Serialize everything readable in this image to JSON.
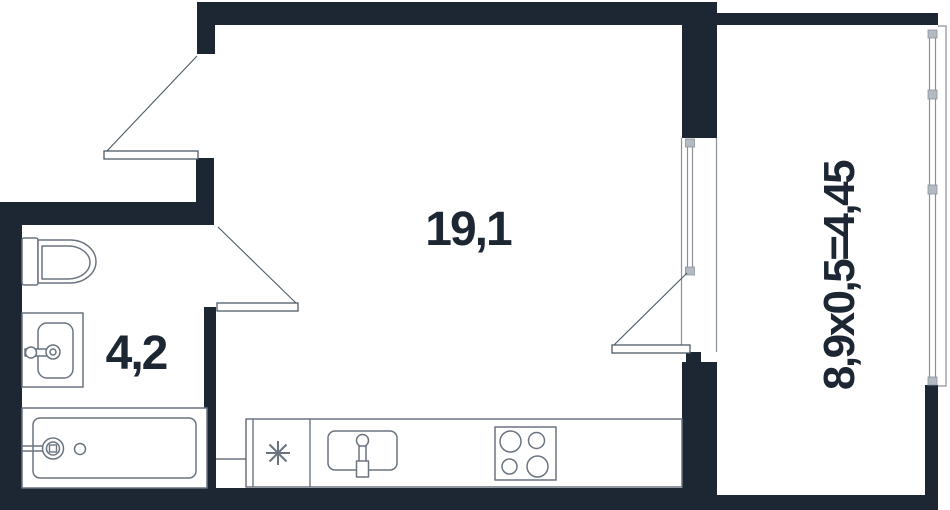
{
  "title": "studio-apartment-floor-plan",
  "rooms": {
    "main": {
      "label": "19,1"
    },
    "bathroom": {
      "label": "4,2"
    },
    "balcony": {
      "label": "8,9x0,5=4,45"
    }
  },
  "fixtures": [
    "toilet",
    "bathroom-sink",
    "bathtub",
    "kitchen-counter",
    "kitchen-sink",
    "stove-4-burners",
    "vent-asterisk"
  ],
  "colors": {
    "wall": "#1c2733",
    "fixture": "#6a7480",
    "door": "#4d5a66",
    "window": "#8a919c",
    "text": "#1c2733",
    "bg": "#ffffff"
  }
}
